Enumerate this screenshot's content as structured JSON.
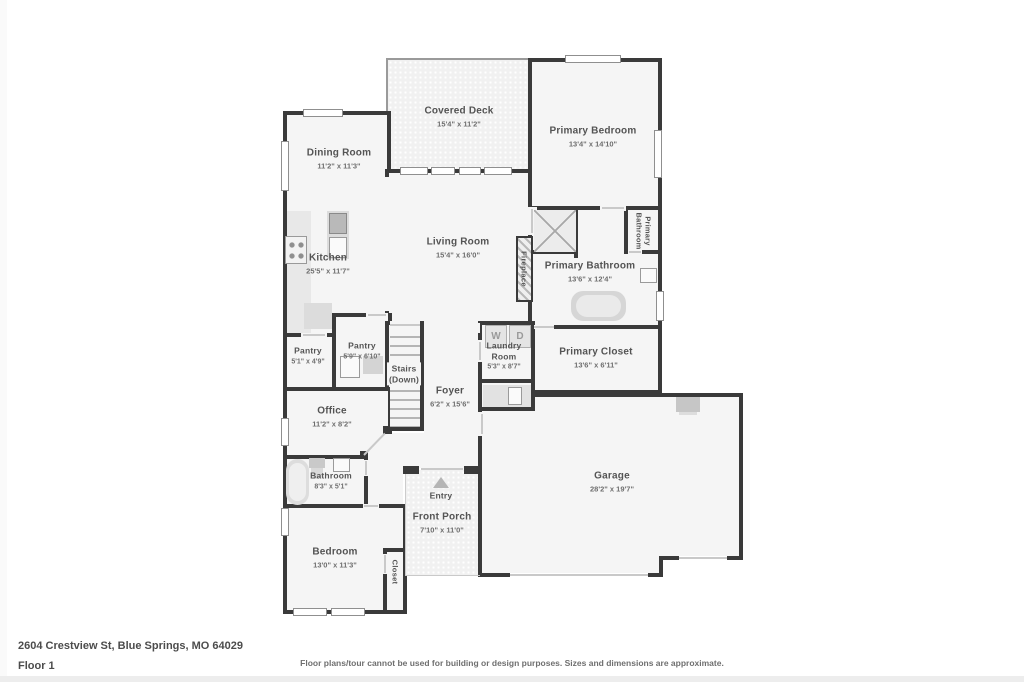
{
  "plan": {
    "wall_color": "#3a3a3a",
    "room_fill": "#f5f5f5",
    "rooms": [
      {
        "id": "covered-deck",
        "name": "Covered Deck",
        "dims": "15'4\" x 11'2\""
      },
      {
        "id": "primary-bedroom",
        "name": "Primary Bedroom",
        "dims": "13'4\" x 14'10\""
      },
      {
        "id": "dining-room",
        "name": "Dining Room",
        "dims": "11'2\" x 11'3\""
      },
      {
        "id": "kitchen",
        "name": "Kitchen",
        "dims": "25'5\" x 11'7\""
      },
      {
        "id": "living-room",
        "name": "Living Room",
        "dims": "15'4\" x 16'0\""
      },
      {
        "id": "fireplace",
        "name": "Fireplace"
      },
      {
        "id": "primary-bathroom-wc",
        "name": "Primary Bathroom"
      },
      {
        "id": "primary-bathroom",
        "name": "Primary Bathroom",
        "dims": "13'6\" x 12'4\""
      },
      {
        "id": "pantry-small",
        "name": "Pantry",
        "dims": "5'1\" x 4'9\""
      },
      {
        "id": "pantry-large",
        "name": "Pantry",
        "dims": "5'9\" x 6'10\""
      },
      {
        "id": "stairs",
        "name": "Stairs",
        "sub": "(Down)"
      },
      {
        "id": "laundry-room",
        "name": "Laundry Room",
        "dims": "5'3\" x 8'7\""
      },
      {
        "id": "primary-closet",
        "name": "Primary Closet",
        "dims": "13'6\" x 6'11\""
      },
      {
        "id": "foyer",
        "name": "Foyer",
        "dims": "6'2\" x 15'6\""
      },
      {
        "id": "office",
        "name": "Office",
        "dims": "11'2\" x 8'2\""
      },
      {
        "id": "bathroom",
        "name": "Bathroom",
        "dims": "8'3\" x 5'1\""
      },
      {
        "id": "entry",
        "name": "Entry"
      },
      {
        "id": "front-porch",
        "name": "Front Porch",
        "dims": "7'10\" x 11'0\""
      },
      {
        "id": "garage",
        "name": "Garage",
        "dims": "28'2\" x 19'7\""
      },
      {
        "id": "bedroom",
        "name": "Bedroom",
        "dims": "13'0\" x 11'3\""
      },
      {
        "id": "closet",
        "name": "Closet"
      }
    ],
    "appliances": {
      "washer": "W",
      "dryer": "D"
    }
  },
  "footer": {
    "address": "2604 Crestview St, Blue Springs, MO 64029",
    "floor": "Floor 1",
    "disclaimer": "Floor plans/tour cannot be used for building or design purposes. Sizes and dimensions are approximate."
  }
}
